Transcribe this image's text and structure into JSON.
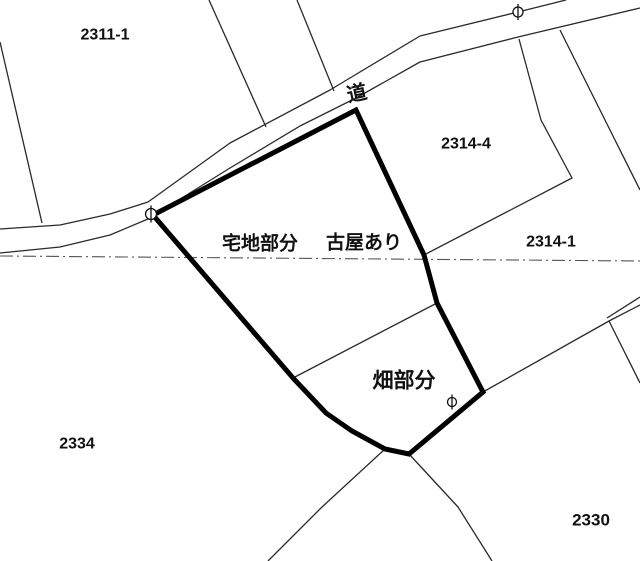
{
  "canvas": {
    "width": 640,
    "height": 561,
    "background": "#ffffff",
    "thin_line_color": "#2a2a2a",
    "thick_line_color": "#000000",
    "dash_line_color": "#555555",
    "thin_width": 1.3,
    "thick_width": 5
  },
  "labels": [
    {
      "name": "label-parcel-2311-1",
      "text": "2311-1",
      "x": 105,
      "y": 35,
      "size": 16,
      "weight": 600,
      "rotate": 0
    },
    {
      "name": "label-road",
      "text": "道",
      "x": 357,
      "y": 94,
      "size": 20,
      "weight": 600,
      "rotate": -12
    },
    {
      "name": "label-parcel-2314-4",
      "text": "2314-4",
      "x": 466,
      "y": 144,
      "size": 16,
      "weight": 600,
      "rotate": 0
    },
    {
      "name": "label-takuchi-bubun",
      "text": "宅地部分",
      "x": 260,
      "y": 244,
      "size": 19,
      "weight": 600,
      "rotate": 0
    },
    {
      "name": "label-furuya-ari",
      "text": "古屋あり",
      "x": 364,
      "y": 243,
      "size": 19,
      "weight": 600,
      "rotate": 0
    },
    {
      "name": "label-parcel-2314-1",
      "text": "2314-1",
      "x": 551,
      "y": 242,
      "size": 16,
      "weight": 600,
      "rotate": 0
    },
    {
      "name": "label-hatake-bubun",
      "text": "畑部分",
      "x": 404,
      "y": 381,
      "size": 21,
      "weight": 600,
      "rotate": 0
    },
    {
      "name": "label-parcel-2334",
      "text": "2334",
      "x": 77,
      "y": 444,
      "size": 16,
      "weight": 600,
      "rotate": 0
    },
    {
      "name": "label-parcel-2330",
      "text": "2330",
      "x": 591,
      "y": 520,
      "size": 17,
      "weight": 600,
      "rotate": 0
    }
  ],
  "subject_parcel": {
    "name": "subject-parcel-outline",
    "points": [
      [
        356,
        110
      ],
      [
        153,
        215
      ],
      [
        293,
        378
      ],
      [
        326,
        413
      ],
      [
        352,
        431
      ],
      [
        385,
        449
      ],
      [
        409,
        454
      ],
      [
        483,
        392
      ],
      [
        437,
        303
      ],
      [
        424,
        255
      ]
    ]
  },
  "thin_lines": [
    {
      "name": "boundary-2311-1-west",
      "points": [
        [
          0,
          42
        ],
        [
          42,
          223
        ]
      ]
    },
    {
      "name": "boundary-2311-1-east",
      "points": [
        [
          209,
          0
        ],
        [
          266,
          127
        ]
      ]
    },
    {
      "name": "boundary-north-mid",
      "points": [
        [
          297,
          0
        ],
        [
          334,
          91
        ]
      ]
    },
    {
      "name": "road-edge-north",
      "points": [
        [
          0,
          229
        ],
        [
          60,
          225
        ],
        [
          110,
          214
        ],
        [
          148,
          202
        ],
        [
          230,
          143
        ],
        [
          330,
          90
        ],
        [
          420,
          36
        ],
        [
          518,
          12
        ],
        [
          566,
          0
        ]
      ]
    },
    {
      "name": "road-edge-south",
      "points": [
        [
          0,
          253
        ],
        [
          60,
          247
        ],
        [
          110,
          235
        ],
        [
          148,
          219
        ],
        [
          230,
          168
        ],
        [
          300,
          126
        ],
        [
          356,
          98
        ],
        [
          420,
          62
        ],
        [
          518,
          37
        ],
        [
          640,
          8
        ]
      ]
    },
    {
      "name": "boundary-2314-4-east",
      "points": [
        [
          519,
          39
        ],
        [
          541,
          120
        ],
        [
          572,
          178
        ],
        [
          424,
          255
        ]
      ]
    },
    {
      "name": "boundary-northeast",
      "points": [
        [
          560,
          30
        ],
        [
          640,
          190
        ]
      ]
    },
    {
      "name": "boundary-2314-1-south",
      "points": [
        [
          0,
          256
        ],
        [
          640,
          261
        ]
      ],
      "dash": "13 4 2 4",
      "color": "#555555",
      "width": 1.1
    },
    {
      "name": "division-takuchi-hatake",
      "points": [
        [
          293,
          378
        ],
        [
          437,
          303
        ]
      ]
    },
    {
      "name": "boundary-southeast-upper",
      "points": [
        [
          483,
          392
        ],
        [
          609,
          321
        ],
        [
          640,
          305
        ]
      ]
    },
    {
      "name": "boundary-southeast-path",
      "points": [
        [
          607,
          318
        ],
        [
          640,
          297
        ]
      ]
    },
    {
      "name": "boundary-southeast-lower",
      "points": [
        [
          609,
          321
        ],
        [
          640,
          383
        ]
      ]
    },
    {
      "name": "boundary-south-west",
      "points": [
        [
          385,
          449
        ],
        [
          322,
          507
        ],
        [
          268,
          561
        ]
      ]
    },
    {
      "name": "boundary-south-east",
      "points": [
        [
          409,
          454
        ],
        [
          458,
          507
        ],
        [
          492,
          561
        ]
      ]
    }
  ],
  "markers": [
    {
      "name": "survey-marker-road",
      "x": 518,
      "y": 12,
      "r": 5
    },
    {
      "name": "survey-marker-west",
      "x": 151,
      "y": 214,
      "r": 5.5
    },
    {
      "name": "survey-marker-field",
      "x": 452,
      "y": 402,
      "r": 4.5
    }
  ]
}
